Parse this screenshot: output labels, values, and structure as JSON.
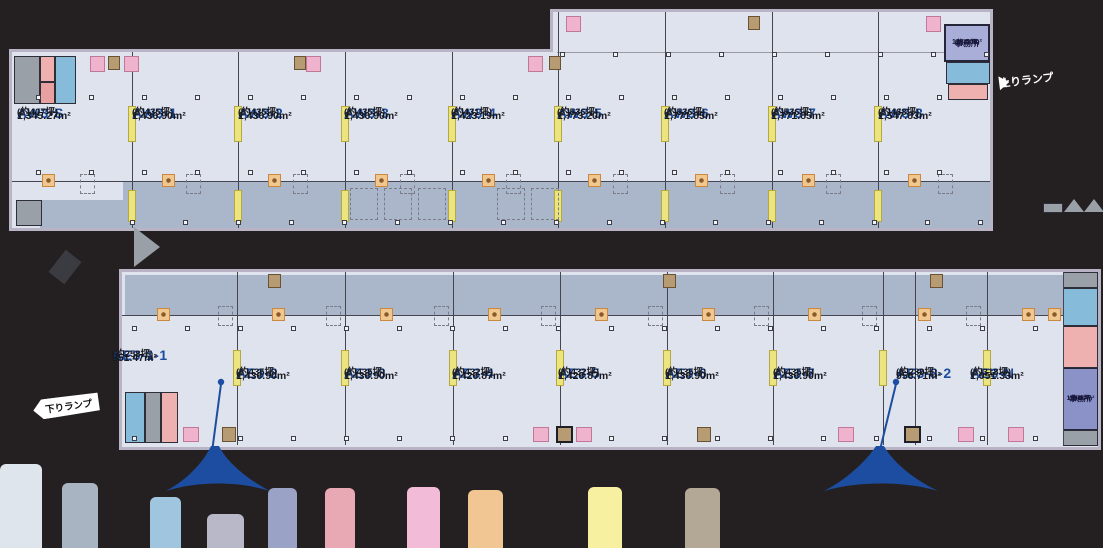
{
  "diagram": {
    "type": "warehouse-floor-plan",
    "upper_floor": {
      "units": [
        {
          "id": "AW3-S",
          "area_m2": "1,345.27m²",
          "area_tsubo": "(約407坪)"
        },
        {
          "id": "AW3-1",
          "area_m2": "1,436.90m²",
          "area_tsubo": "(約435坪)"
        },
        {
          "id": "AW3-2",
          "area_m2": "1,436.90m²",
          "area_tsubo": "(約435坪)"
        },
        {
          "id": "AW3-3",
          "area_m2": "1,436.90m²",
          "area_tsubo": "(約435坪)"
        },
        {
          "id": "AW3-4",
          "area_m2": "1,423.19m²",
          "area_tsubo": "(約431坪)"
        },
        {
          "id": "AW3-5",
          "area_m2": "1,773.20m²",
          "area_tsubo": "(約536坪)"
        },
        {
          "id": "AW3-6",
          "area_m2": "1,771.85m²",
          "area_tsubo": "(約536坪)"
        },
        {
          "id": "AW3-7",
          "area_m2": "1,771.85m²",
          "area_tsubo": "(約536坪)"
        },
        {
          "id": "AW3-8",
          "area_m2": "1,547.83m²",
          "area_tsubo": "(約468坪)"
        }
      ],
      "office": {
        "label": "事務所",
        "area_m2": "126.50m²",
        "area_tsubo": "(約38坪)"
      },
      "ramp_label": "上りランプ"
    },
    "lower_floor": {
      "units": [
        {
          "id": "AE3-1-1",
          "area_m2": "851.47m²",
          "area_tsubo": "(約258坪)"
        },
        {
          "id": "AE3-2",
          "area_m2": "1,436.90m²",
          "area_tsubo": "(約435坪)"
        },
        {
          "id": "AE3-3",
          "area_m2": "1,436.90m²",
          "area_tsubo": "(約435坪)"
        },
        {
          "id": "AE3-4",
          "area_m2": "1,426.87m²",
          "area_tsubo": "(約432坪)"
        },
        {
          "id": "AE3-5",
          "area_m2": "1,426.87m²",
          "area_tsubo": "(約432坪)"
        },
        {
          "id": "AE3-6",
          "area_m2": "1,436.90m²",
          "area_tsubo": "(約435坪)"
        },
        {
          "id": "AE3-7",
          "area_m2": "1,436.90m²",
          "area_tsubo": "(約435坪)"
        },
        {
          "id": "AE3-8-2",
          "area_m2": "956.71m²",
          "area_tsubo": "(約289坪)"
        },
        {
          "id": "AE3-N",
          "area_m2": "1,051.33m²",
          "area_tsubo": "(約318坪)"
        }
      ],
      "office": {
        "label": "事務所",
        "area_m2": "159.67m²",
        "area_tsubo": "(約48坪)"
      },
      "ramp_label": "下りランプ"
    },
    "colors": {
      "unit_label": "#1b4c9e",
      "floor": "#dfe3ed",
      "dock_strip": "#aab7cb",
      "wall": "#b9b3c6",
      "background": "#242021",
      "dock_door_yellow": "#ece47f",
      "pillar_orange": "#f0c88f",
      "amenity_pink": "#efb3cd",
      "elevator_tan": "#b79b72",
      "pin_blue": "#1d4da0"
    }
  }
}
